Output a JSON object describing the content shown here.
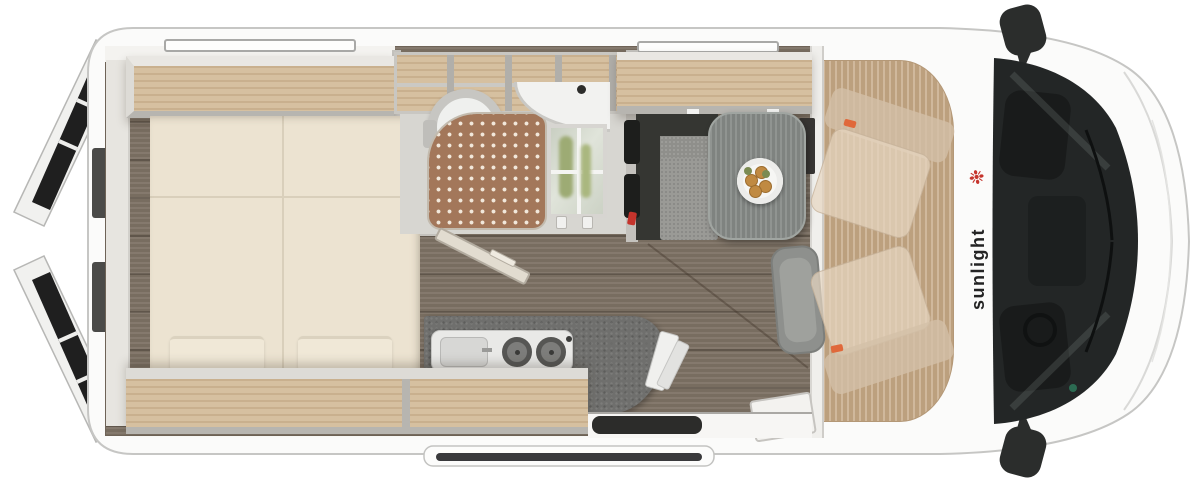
{
  "image": {
    "type": "floorplan",
    "subject": "camper-van-top-view"
  },
  "brand": {
    "logo_text": "sunlight"
  },
  "icons": [
    {
      "name": "palm-icon",
      "glyph": "❉"
    }
  ],
  "counts": {
    "pillows": 2,
    "burners": 2,
    "ghost_seats": 2,
    "rear_doors": 2,
    "side_mirrors": 2
  },
  "colors": {
    "body_white": "#fbfbfa",
    "outline_grey": "#c6c6c4",
    "floor_wood": "#7d7164",
    "cab_wood": "#c6aa88",
    "cabinet_wood": "#d6c0a0",
    "shelf_lip": "#e9e7e3",
    "shelf_edge": "#b7b5b0",
    "mattress": "#ece3d1",
    "pillow": "#f0e8d7",
    "bath_floor": "#d7d6d1",
    "shower_mat": "#a3775a",
    "mat_dot": "#f2e8db",
    "porcelain": "#eff0ee",
    "counter_grey": "#6f6f6d",
    "stove_white": "#e9e9e7",
    "table_grey": "#878b88",
    "bench_dark": "#353632",
    "cushion_grey": "#9a9a96",
    "seat_grey": "#8e908d",
    "glass_dark": "#232626",
    "mirror_black": "#2b2d2c",
    "wall_grey": "#c4c2bd",
    "step_dark": "#3a3a3c",
    "window_dark": "#1f1f1f",
    "cabinet_glass": "#ccd2c5",
    "plant_green": "#9dab74",
    "food_orange": "#c08a42",
    "food_green": "#7b8b52",
    "accent_red": "#c5342c",
    "accent_orange": "#e0683a"
  }
}
